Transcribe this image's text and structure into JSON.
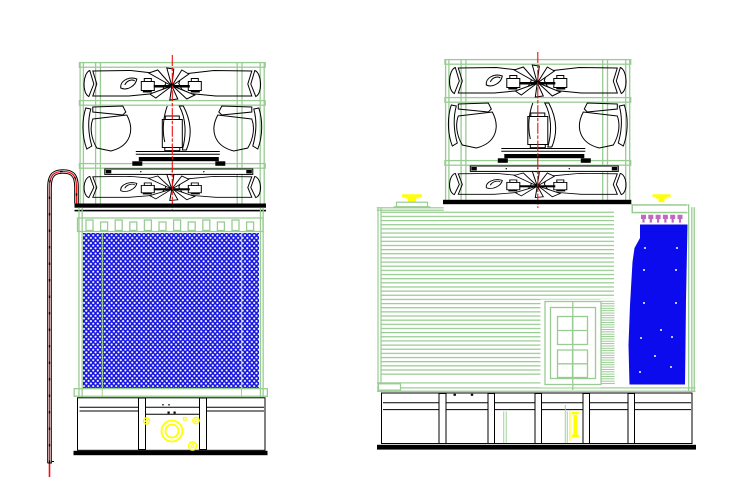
{
  "drawing": {
    "kind": "cooling-tower-elevation-cad-drawing",
    "background": "#FFFFFF",
    "views": {
      "left": {
        "name": "front-elevation",
        "components": [
          "fan-assembly",
          "fan-deck",
          "distribution-nozzle-strip",
          "fill-mesh-panel",
          "collection-basin",
          "pump-circles",
          "riser-pipe"
        ]
      },
      "right": {
        "name": "side-elevation",
        "components": [
          "fan-assembly",
          "fan-deck",
          "inlet-louvers",
          "access-door",
          "spray-nozzles",
          "cascade-panel",
          "collection-basin",
          "vent-caps"
        ]
      }
    }
  },
  "colors": {
    "green": "#98CC92",
    "red": "#EE1111",
    "blue": "#0B0BEE",
    "meshblue": "#1616E0",
    "yellow": "#FFFF00",
    "purple": "#C168C1",
    "black": "#000000",
    "white": "#FFFFFF"
  }
}
